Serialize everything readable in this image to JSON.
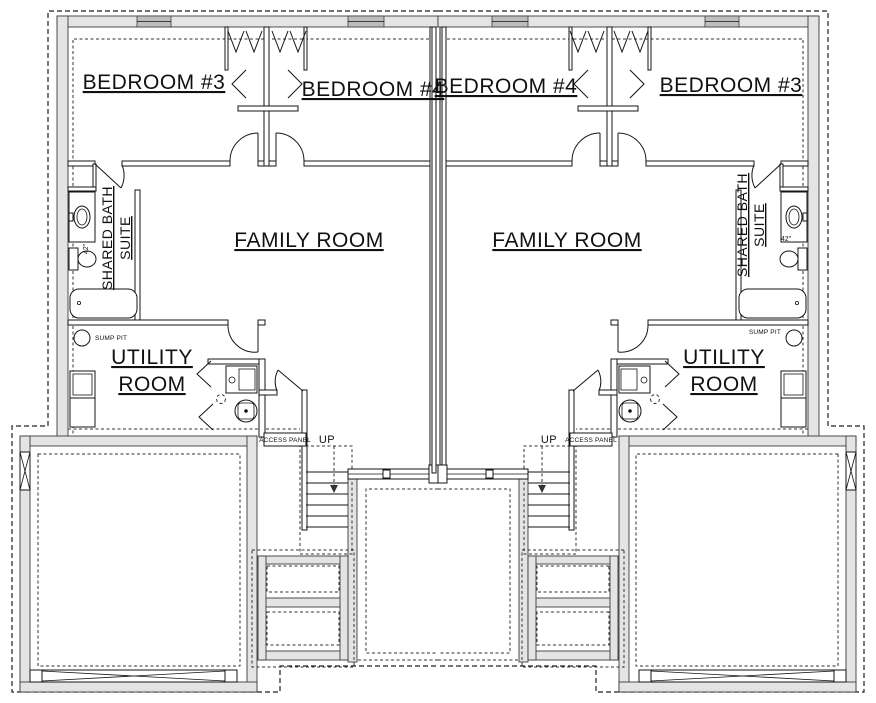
{
  "drawing": {
    "kind": "mirrored duplex basement floor plan",
    "labels": {
      "bedroom3": "BEDROOM #3",
      "bedroom4": "BEDROOM #4",
      "family_room": "FAMILY ROOM",
      "shared_bath_line1": "SHARED BATH",
      "shared_bath_line2": "SUITE",
      "utility_line1": "UTILITY",
      "utility_line2": "ROOM",
      "sump_pit": "SUMP PIT",
      "access_panel": "ACCESS PANEL",
      "up": "UP",
      "vanity_width": "42\""
    },
    "colors": {
      "line": "#1c1c1c",
      "wall_fill": "#e4e4e4",
      "window_fill": "#bdbdbd",
      "background": "#ffffff"
    }
  }
}
